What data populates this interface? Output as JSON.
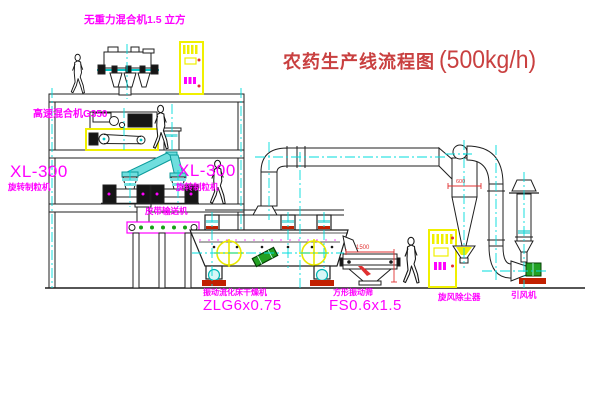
{
  "diagram": {
    "title": "农药生产线流程图",
    "title_capacity": "(500kg/h)",
    "labels": {
      "gravity_free_mixer": "无重力混合机1.5 立方",
      "high_speed_mixer": "高速混合机G350",
      "granulator_model_left": "XL-300",
      "granulator_name_left": "旋转制粒机",
      "granulator_model_right": "XL-300",
      "granulator_name_right": "旋转制粒机",
      "belt_conveyor": "皮带输送机",
      "dryer_name": "振动流化床干燥机",
      "dryer_model": "ZLG6x0.75",
      "screen_name": "方形振动筛",
      "screen_model": "FS0.6x1.5",
      "cyclone": "旋风除尘器",
      "fan": "引风机"
    },
    "dimensions": {
      "screen_length": "1500",
      "cyclone_width": "600"
    },
    "colors": {
      "label_magenta": "#ff00ff",
      "title_red": "#c94040",
      "dimension_red": "#e03030",
      "centerline_cyan": "#00dcdc",
      "cabinet_yellow": "#f0f000",
      "machine_green": "#22a022",
      "line_black": "#1f1f1f",
      "background": "#ffffff"
    }
  }
}
